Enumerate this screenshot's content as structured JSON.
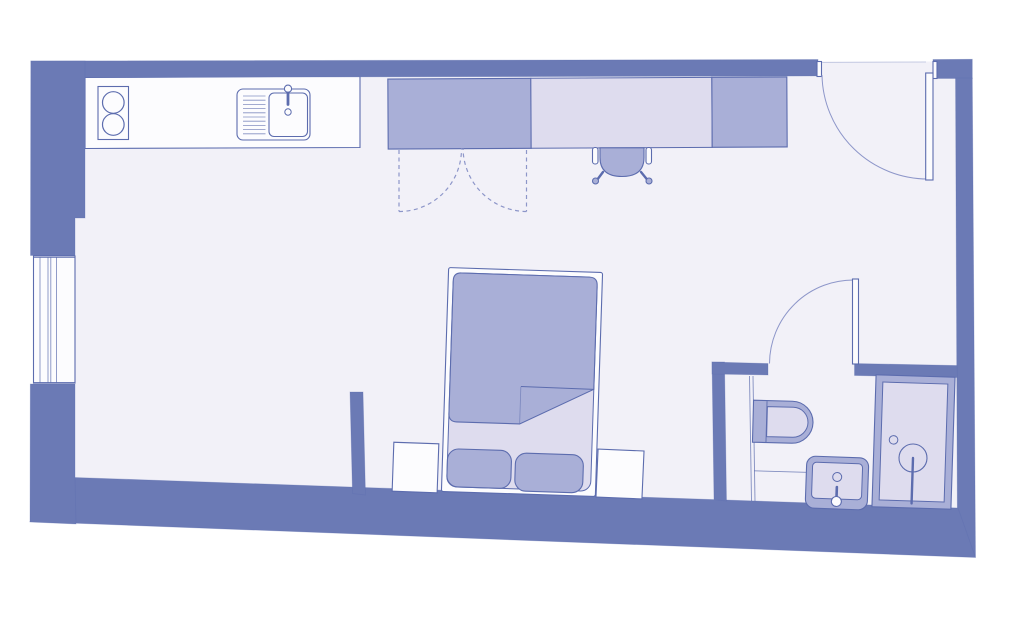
{
  "plan": {
    "label": "studio-apartment-floor-plan",
    "type": "floor-plan"
  },
  "palette": {
    "background": "#ffffff",
    "wall": "#6b7ab5",
    "floor": "#f2f1f8",
    "fixture_white": "#fcfcfe",
    "fixture_light": "#dedcee",
    "fixture_medium": "#a9afd7",
    "outline": "#5c6cae",
    "swing": "#8d96c9",
    "threshold": "#c6cbe3"
  },
  "elements": {
    "rooms": [
      "main-room",
      "bathroom"
    ],
    "fixtures": [
      "cooktop",
      "kitchen-sink",
      "kitchen-counter",
      "wardrobe",
      "desk",
      "desk-chair",
      "entrance-door",
      "window",
      "bed",
      "duvet",
      "pillow",
      "nightstand",
      "bathroom-door",
      "toilet",
      "washbasin",
      "shower"
    ]
  }
}
